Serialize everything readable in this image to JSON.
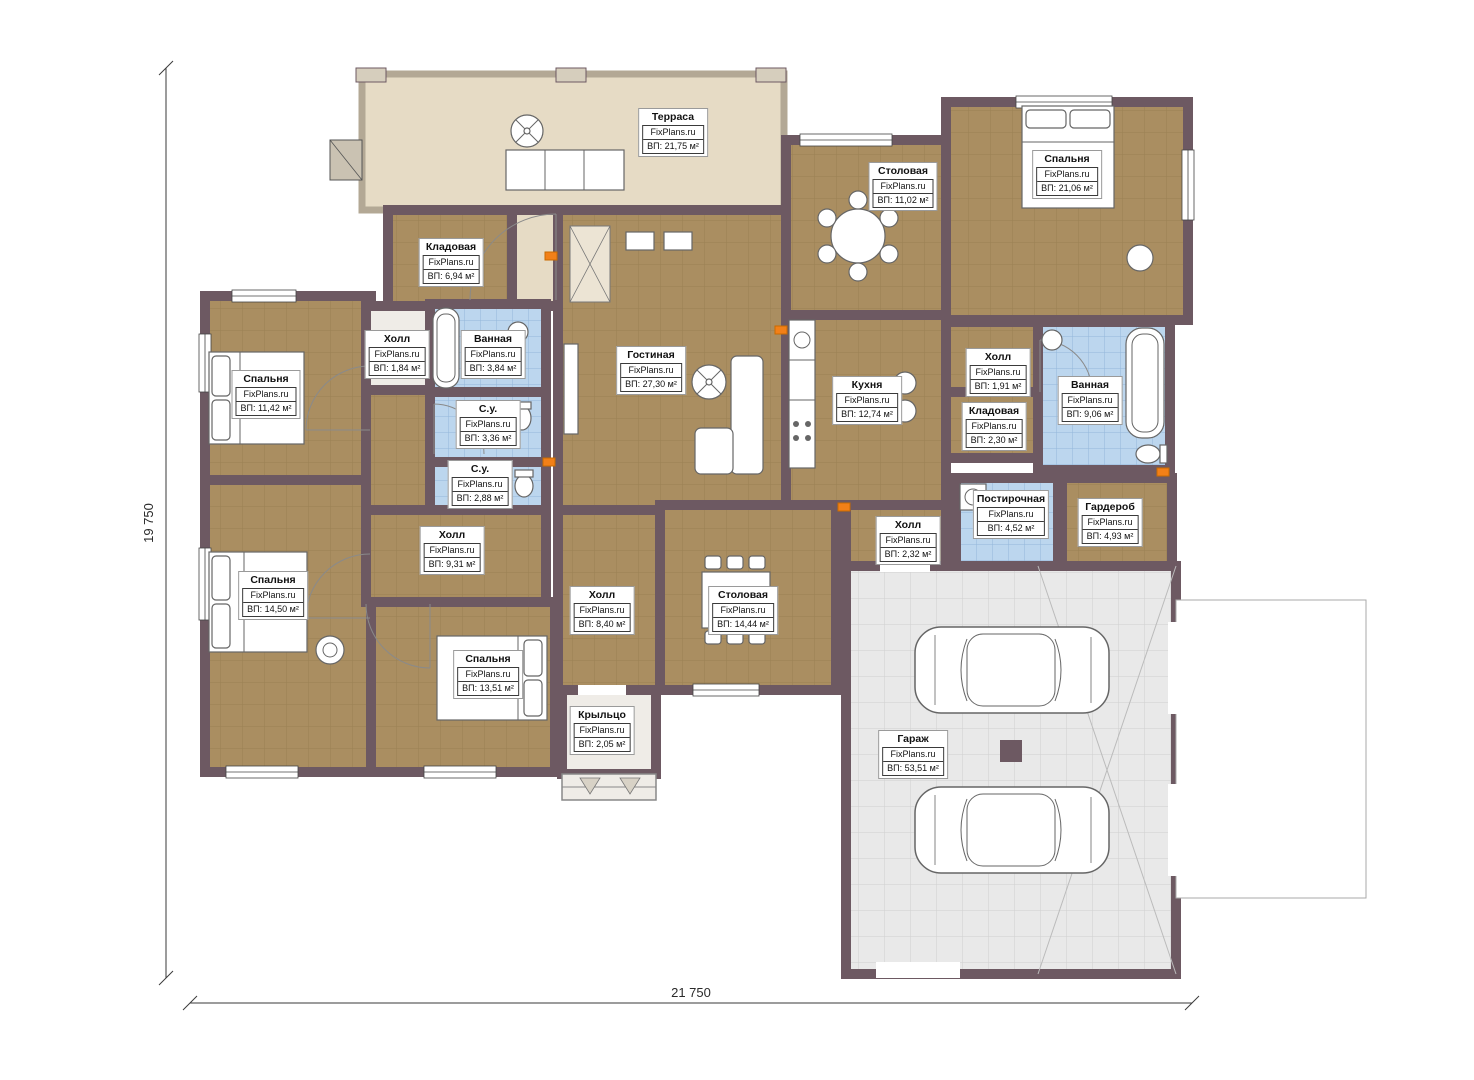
{
  "brand": "FixPlans.ru",
  "dimensions": {
    "left": "19 750",
    "bottom": "21 750"
  },
  "rooms": {
    "terrace": {
      "name": "Терраса",
      "area": "ВП: 21,75 м²"
    },
    "dining_top": {
      "name": "Столовая",
      "area": "ВП: 11,02 м²"
    },
    "bedroom_tr": {
      "name": "Спальня",
      "area": "ВП: 21,06 м²"
    },
    "storage_top": {
      "name": "Кладовая",
      "area": "ВП: 6,94 м²"
    },
    "hall_left": {
      "name": "Холл",
      "area": "ВП: 1,84 м²"
    },
    "bath_left": {
      "name": "Ванная",
      "area": "ВП: 3,84 м²"
    },
    "living": {
      "name": "Гостиная",
      "area": "ВП: 27,30 м²"
    },
    "wc_1": {
      "name": "С.у.",
      "area": "ВП: 3,36 м²"
    },
    "wc_2": {
      "name": "С.у.",
      "area": "ВП: 2,88 м²"
    },
    "bedroom_l1": {
      "name": "Спальня",
      "area": "ВП: 11,42 м²"
    },
    "kitchen": {
      "name": "Кухня",
      "area": "ВП: 12,74 м²"
    },
    "hall_right": {
      "name": "Холл",
      "area": "ВП: 1,91 м²"
    },
    "bath_right": {
      "name": "Ванная",
      "area": "ВП: 9,06 м²"
    },
    "storage_right": {
      "name": "Кладовая",
      "area": "ВП: 2,30 м²"
    },
    "laundry": {
      "name": "Постирочная",
      "area": "ВП: 4,52 м²"
    },
    "wardrobe": {
      "name": "Гардероб",
      "area": "ВП: 4,93 м²"
    },
    "hall_small": {
      "name": "Холл",
      "area": "ВП: 2,32 м²"
    },
    "hall_center": {
      "name": "Холл",
      "area": "ВП: 9,31 м²"
    },
    "bedroom_l2": {
      "name": "Спальня",
      "area": "ВП: 14,50 м²"
    },
    "hall_mid": {
      "name": "Холл",
      "area": "ВП: 8,40 м²"
    },
    "dining_mid": {
      "name": "Столовая",
      "area": "ВП: 14,44 м²"
    },
    "bedroom_bottom": {
      "name": "Спальня",
      "area": "ВП: 13,51 м²"
    },
    "porch": {
      "name": "Крыльцо",
      "area": "ВП: 2,05 м²"
    },
    "garage": {
      "name": "Гараж",
      "area": "ВП: 53,51 м²"
    }
  },
  "colors": {
    "wall": "#6d5962",
    "floor_wood": "#aa8e61",
    "floor_bath": "#bcd6ee",
    "floor_terrace": "#e6dbc5",
    "floor_garage": "#e9e9e9",
    "heater": "#f28018"
  }
}
